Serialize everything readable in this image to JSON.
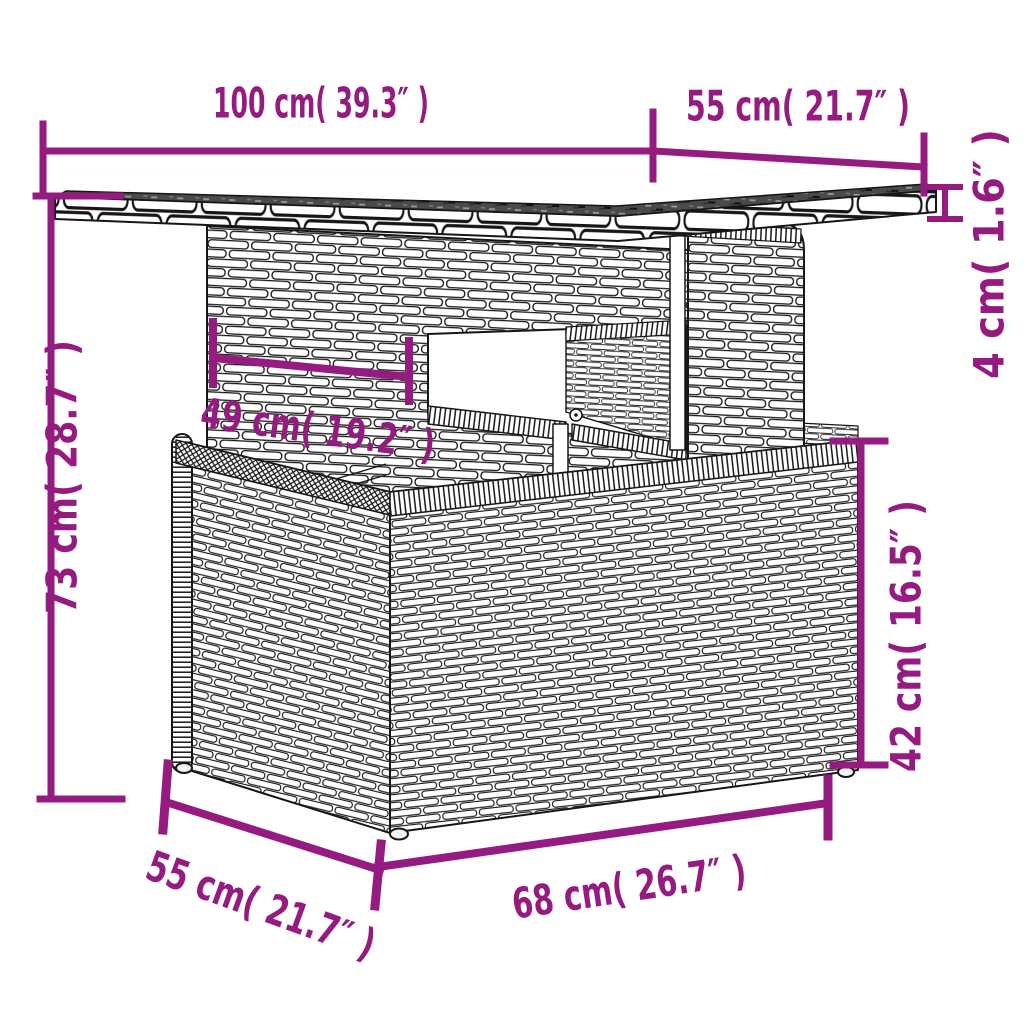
{
  "diagram": {
    "type": "product-dimensions",
    "depicts": "poly rattan garden table line drawing with dimension annotations",
    "colors": {
      "dimension_annotation": "#951B81",
      "line_art": "#161616",
      "tabletop_surface": "#4A4A4A",
      "background": "#FFFFFF"
    },
    "dimensions": [
      {
        "id": "tabletop-width",
        "label": "100 cm( 39.3″ )",
        "value_cm": 100,
        "value_in": 39.3
      },
      {
        "id": "tabletop-depth",
        "label": "55 cm( 21.7″ )",
        "value_cm": 55,
        "value_in": 21.7
      },
      {
        "id": "tabletop-thickness",
        "label": "4 cm( 1.6″ )",
        "value_cm": 4,
        "value_in": 1.6
      },
      {
        "id": "total-height",
        "label": "73 cm( 28.7″ )",
        "value_cm": 73,
        "value_in": 28.7
      },
      {
        "id": "pedestal-width",
        "label": "49 cm( 19.2″ )",
        "value_cm": 49,
        "value_in": 19.2
      },
      {
        "id": "base-height",
        "label": "42 cm( 16.5″ )",
        "value_cm": 42,
        "value_in": 16.5
      },
      {
        "id": "base-depth",
        "label": "55 cm( 21.7″ )",
        "value_cm": 55,
        "value_in": 21.7
      },
      {
        "id": "base-width",
        "label": "68 cm( 26.7″ )",
        "value_cm": 68,
        "value_in": 26.7
      }
    ]
  }
}
